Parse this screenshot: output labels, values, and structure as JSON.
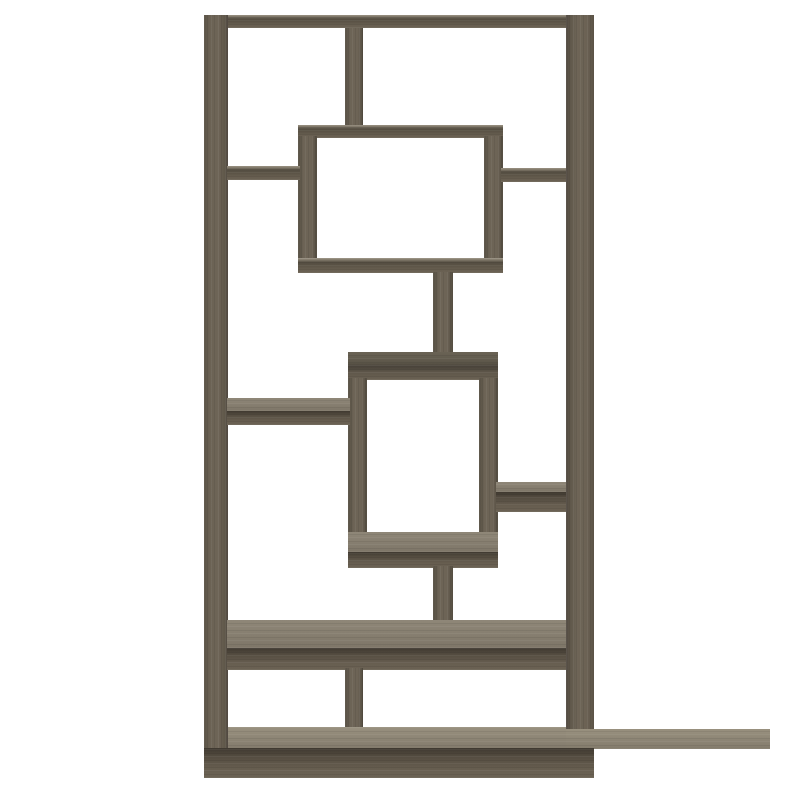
{
  "image": {
    "type": "product-photo",
    "subject": "Geometric bookcase with interlocking rectangular open shelves",
    "finish": "weathered grey wood",
    "background_color": "#ffffff"
  },
  "palette": {
    "bg": "#ffffff",
    "wood_front": "#675e50",
    "wood_dark": "#4d463b",
    "wood_top_light": "#8f8778",
    "wood_top_bright": "#99917f",
    "wood_olive_top": "#5d574a",
    "wood_side_shadow": "#554e42"
  },
  "parts": {
    "frame": [
      "top-panel",
      "left-side-panel",
      "right-side-panel",
      "bottom-panel"
    ],
    "dividers": [
      "top-center-divider",
      "bottom-center-divider"
    ],
    "boxes": [
      "upper-display-box",
      "middle-display-box"
    ],
    "shelves": [
      "upper-left-shelf",
      "upper-right-shelf",
      "middle-left-shelf",
      "lower-right-shelf",
      "lower-wide-shelf"
    ],
    "posts": [
      "upper-center-post",
      "lower-center-post"
    ]
  }
}
